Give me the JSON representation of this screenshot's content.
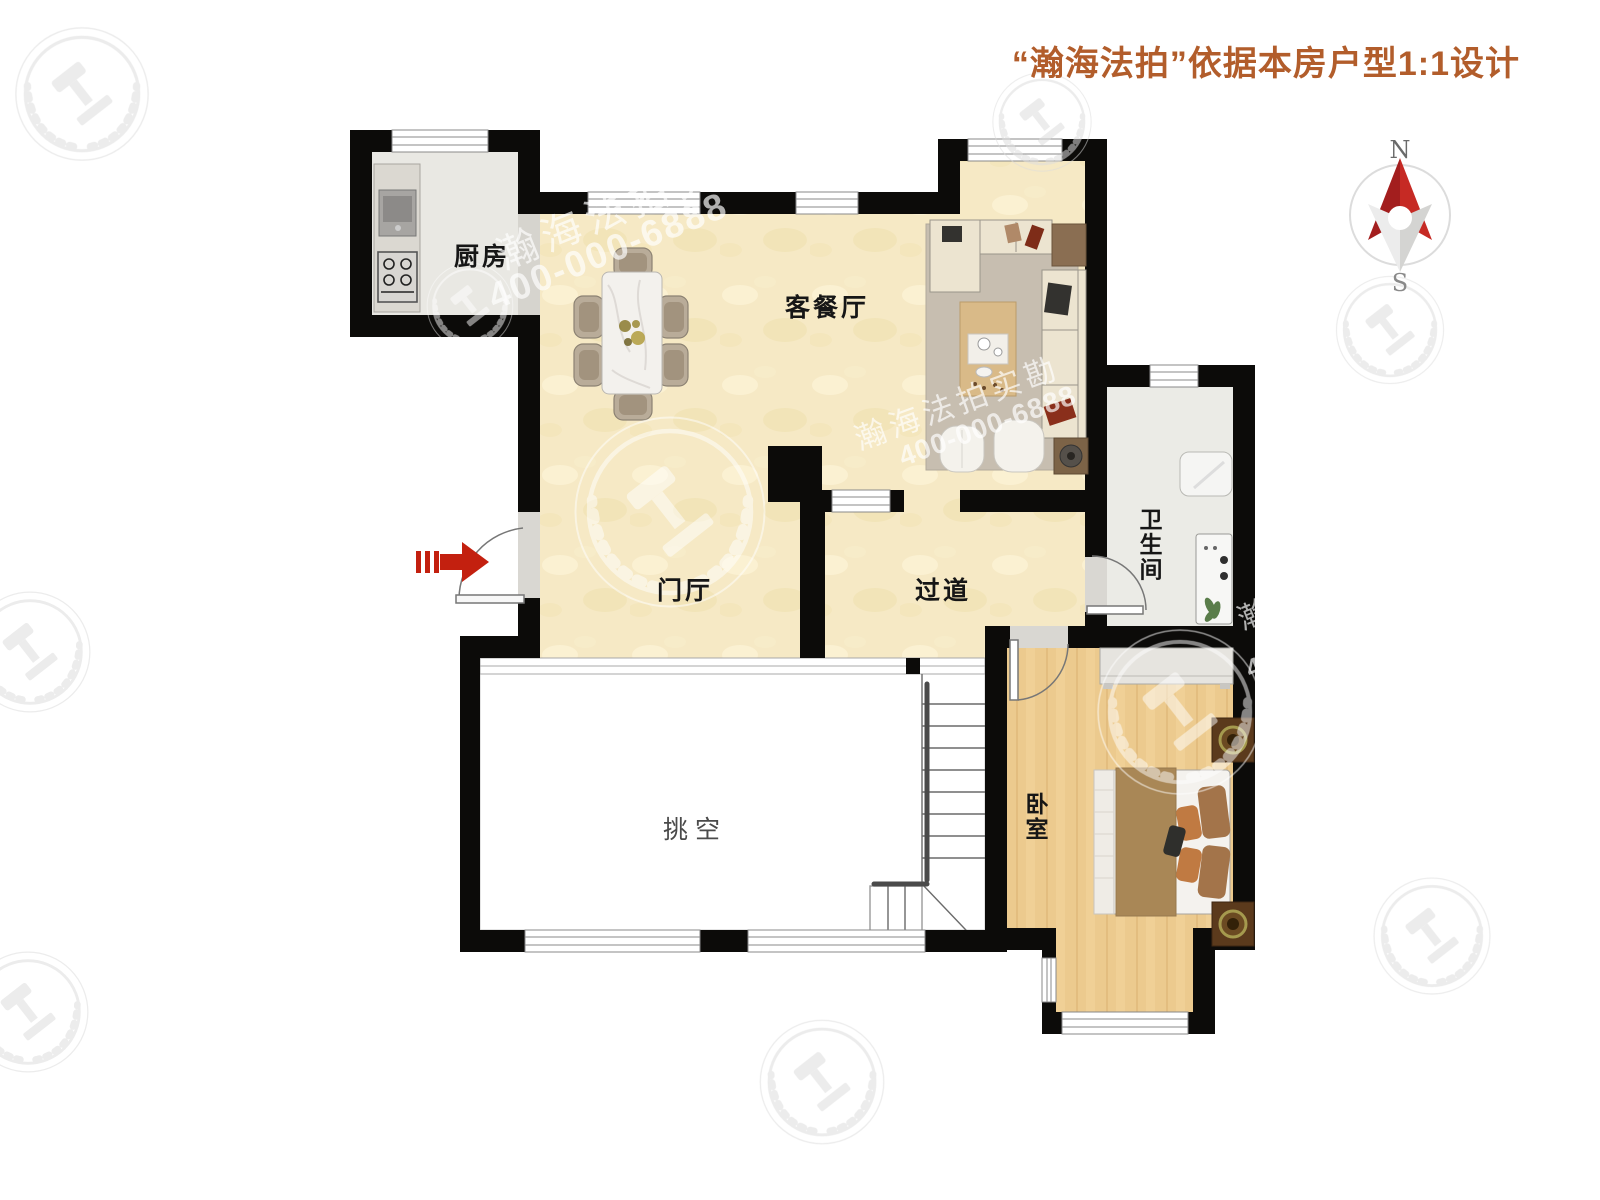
{
  "title": {
    "text": "“瀚海法拍”依据本房户型1:1设计"
  },
  "compass": {
    "north": "N",
    "south": "S"
  },
  "rooms": {
    "kitchen": {
      "label": "厨房"
    },
    "living_dining": {
      "label": "客餐厅"
    },
    "entry_hall": {
      "label": "门厅"
    },
    "corridor": {
      "label": "过道"
    },
    "bathroom": {
      "label": "卫生间"
    },
    "bedroom": {
      "label": "卧室"
    },
    "void": {
      "label": "挑空"
    }
  },
  "watermark": {
    "brand": "瀚海法拍实勘",
    "phone": "400-000-6888",
    "partial_char": "瀚",
    "partial_digit": "4"
  },
  "colors": {
    "title_text": "#b25d2b",
    "wall": "#0c0b09",
    "entrance_arrow": "#c3200f",
    "compass_north": "#c62a24",
    "floor_cream": "#f6e9c5",
    "floor_wood": "#ecca8e",
    "floor_kitchen": "#e9e8e3",
    "floor_bathroom": "#ebebe6",
    "rug": "#c7beb0",
    "sofa": "#ece4d0",
    "bed_blanket": "#a98756"
  }
}
